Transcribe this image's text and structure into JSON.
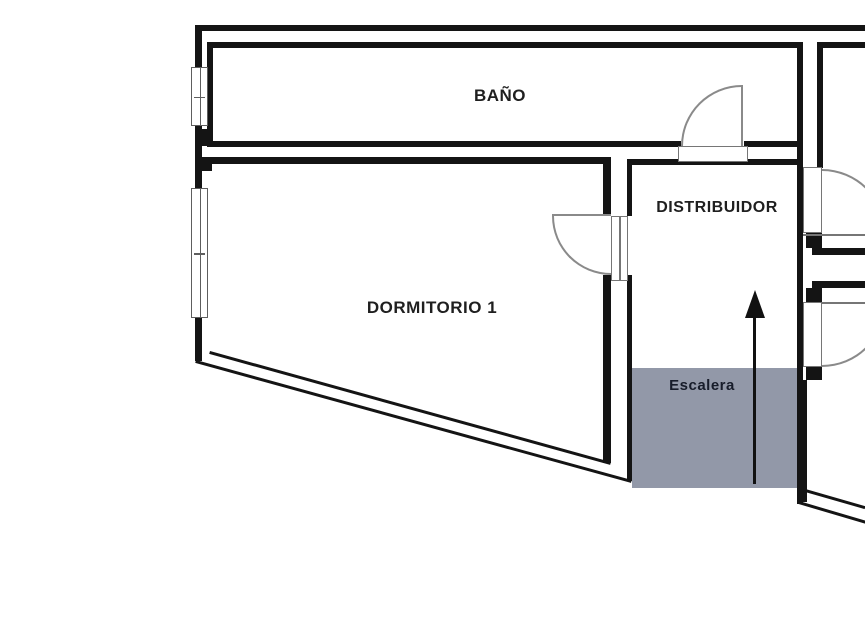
{
  "plan": {
    "type": "floor-plan",
    "labels": {
      "bano": "BAÑO",
      "dormitorio": "DORMITORIO 1",
      "distribuidor": "DISTRIBUIDOR",
      "escalera": "Escalera"
    },
    "features": {
      "windows": 2,
      "door_arcs": 4,
      "stair_direction_arrow": "up"
    },
    "colors": {
      "wall": "#141414",
      "thin_line": "#767676",
      "door_arc": "#8a8a8a",
      "stair_fill": "#9298a8",
      "label_text": "#1f1f1f"
    }
  }
}
